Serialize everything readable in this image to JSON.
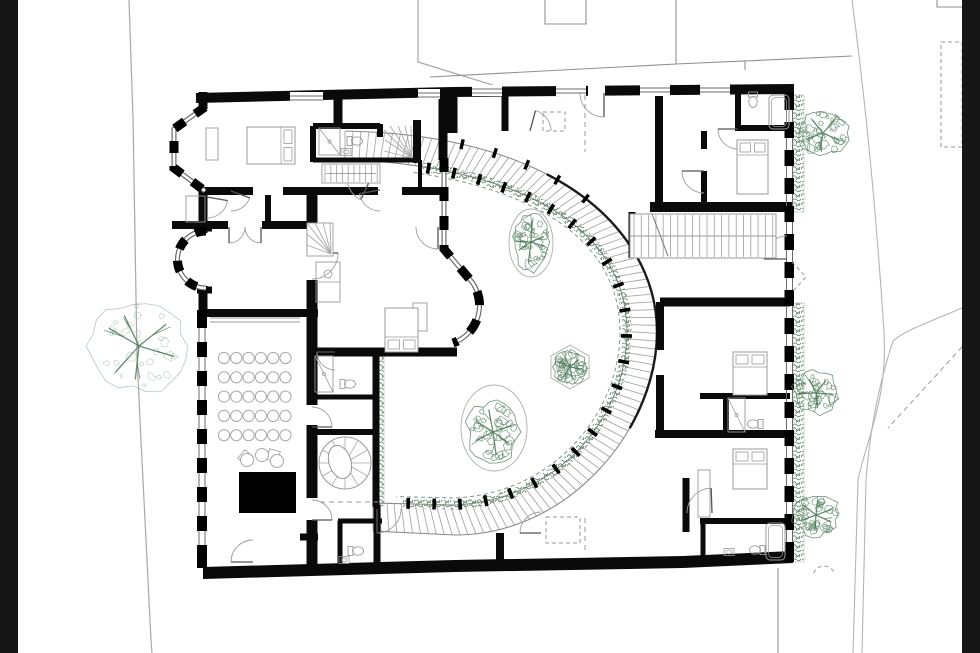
{
  "title": "floor-plan-drawing",
  "canvas": {
    "w": 980,
    "h": 653
  },
  "colors": {
    "paper": "#ffffff",
    "bar": "#161616",
    "wall": "#0a0a0a",
    "thin": "#9a9a9a",
    "boundary": "#a8a8a8",
    "road": "#b5b5b5",
    "neighbor": "#8f8f8f",
    "glaze": "#6b6b6b",
    "tread": "#a8a8a8",
    "dash": "#9a9a9a",
    "furn": "#9a9a9a",
    "seat": "#a8a8a8",
    "treeLight": "#9cb8a3",
    "treeDark": "#5d8768",
    "branch": "#4c7c59",
    "veg": "#55815f",
    "rail": "#7d9b88",
    "stage": "#000000"
  },
  "letterbox": {
    "left": [
      0,
      0,
      18,
      653
    ],
    "right": [
      962,
      0,
      18,
      653
    ]
  },
  "paperRect": [
    18,
    0,
    944,
    653
  ],
  "siteBoundaries": [
    "M129,0 L133,118 L137,356 L140,420 L151,640 L152,653",
    "M418,0 L418,62 L512,91"
  ],
  "neighborLines": [
    "M430,77 L676,64 L676,0",
    "M676,64 L745,61 L745,70",
    "M745,61 L852,56",
    "M545,0 L545,24 L586,24 L586,0",
    "M937,0 L937,7 L962,7",
    "M778,568 L778,653"
  ],
  "roads": [
    "M852,0 C868,120 878,240 884,332 C888,400 866,440 858,480 L853,653",
    "M962,308 C930,322 905,330 893,341 C877,390 869,440 866,480 L862,653"
  ],
  "dashedLines": [
    [
      585,
      95,
      585,
      152
    ],
    [
      585,
      518,
      585,
      552
    ],
    [
      320,
      502,
      378,
      502
    ],
    [
      962,
      347,
      888,
      428
    ]
  ],
  "dashedRects": [
    [
      543,
      112,
      22,
      19
    ],
    [
      546,
      517,
      34,
      26
    ],
    [
      941,
      42,
      21,
      105
    ]
  ],
  "dashedPolys": [
    "M792,262 L806,277 L792,292"
  ],
  "dashedArcs": [
    {
      "cx": 824,
      "cy": 577,
      "r": 11,
      "a0": 200,
      "a1": 340
    }
  ],
  "walls": [
    [
      196,
      98,
      452,
      92,
      10
    ],
    [
      452,
      92,
      794,
      89,
      10
    ],
    [
      452,
      88,
      452,
      133,
      11
    ],
    [
      443,
      92,
      443,
      160,
      9
    ],
    [
      505,
      93,
      505,
      131,
      7
    ],
    [
      659,
      92,
      659,
      211,
      8
    ],
    [
      704,
      131,
      704,
      149,
      6
    ],
    [
      704,
      171,
      704,
      211,
      6
    ],
    [
      738,
      92,
      738,
      129,
      6
    ],
    [
      735,
      128,
      792,
      128,
      6
    ],
    [
      650,
      207,
      792,
      207,
      10
    ],
    [
      660,
      302,
      790,
      302,
      9
    ],
    [
      660,
      302,
      660,
      350,
      8
    ],
    [
      660,
      375,
      660,
      434,
      8
    ],
    [
      655,
      434,
      790,
      434,
      8
    ],
    [
      700,
      396,
      790,
      396,
      6
    ],
    [
      726,
      396,
      726,
      434,
      6
    ],
    [
      700,
      521,
      790,
      521,
      6
    ],
    [
      703,
      521,
      703,
      560,
      5
    ],
    [
      686,
      478,
      686,
      532,
      7
    ],
    [
      312,
      195,
      312,
      253,
      11
    ],
    [
      312,
      280,
      312,
      405,
      11
    ],
    [
      312,
      425,
      312,
      498,
      11
    ],
    [
      312,
      520,
      312,
      575,
      11
    ],
    [
      203,
      191,
      253,
      191,
      8
    ],
    [
      283,
      191,
      378,
      191,
      8
    ],
    [
      402,
      191,
      447,
      191,
      8
    ],
    [
      172,
      225,
      228,
      225,
      8
    ],
    [
      262,
      225,
      312,
      225,
      8
    ],
    [
      268,
      195,
      268,
      225,
      6
    ],
    [
      203,
      92,
      203,
      109,
      9
    ],
    [
      203,
      189,
      203,
      233,
      9
    ],
    [
      203,
      286,
      203,
      315,
      9
    ],
    [
      197,
      228,
      212,
      228,
      7
    ],
    [
      197,
      290,
      212,
      290,
      7
    ],
    [
      205,
      313,
      318,
      313,
      8
    ],
    [
      308,
      352,
      457,
      352,
      9
    ],
    [
      376,
      352,
      376,
      507,
      7
    ],
    [
      312,
      397,
      376,
      397,
      5
    ],
    [
      312,
      432,
      376,
      432,
      6
    ],
    [
      340,
      521,
      340,
      572,
      5
    ],
    [
      338,
      521,
      382,
      521,
      5
    ],
    [
      377,
      505,
      377,
      572,
      7
    ],
    [
      313,
      126,
      380,
      126,
      6
    ],
    [
      380,
      124,
      380,
      137,
      6
    ],
    [
      417,
      120,
      417,
      163,
      8
    ],
    [
      313,
      160,
      420,
      160,
      5
    ],
    [
      313,
      126,
      313,
      162,
      6
    ],
    [
      420,
      160,
      420,
      191,
      4
    ],
    [
      338,
      92,
      338,
      127,
      9
    ],
    [
      300,
      537,
      318,
      537,
      7
    ],
    [
      500,
      533,
      500,
      564,
      8
    ],
    [
      632,
      212,
      632,
      258,
      7
    ]
  ],
  "wallPolys": [
    [
      [
        203,
        567
      ],
      [
        455,
        560
      ],
      [
        683,
        556
      ],
      [
        683,
        568
      ],
      [
        455,
        572
      ],
      [
        203,
        579
      ]
    ],
    [
      [
        683,
        556
      ],
      [
        793,
        551
      ],
      [
        793,
        563
      ],
      [
        683,
        568
      ]
    ]
  ],
  "facades": [
    {
      "d": "M205,107 L174,129 L174,168 L205,191",
      "dash": "12 13"
    },
    {
      "d": "M206,231 A28 28 0 1 0 206,288",
      "dash": "11 12"
    },
    {
      "d": "M444,158 L444,249 L472,282 A40 40 0 0 1 453,343",
      "dash": "14 15"
    }
  ],
  "pierWalls": [
    {
      "x1": 786.5,
      "x2": 792.5,
      "y0": 92,
      "y1": 562,
      "bx": 784.5,
      "bw": 9.5,
      "from": 94,
      "step": 28,
      "bh": 16,
      "caps": [
        [
          92,
          16
        ],
        [
          544,
          18
        ]
      ]
    },
    {
      "x1": 199,
      "x2": 205,
      "y0": 310,
      "y1": 568,
      "bx": 197,
      "bw": 10,
      "from": 313,
      "step": 29,
      "bh": 15,
      "caps": [
        [
          310,
          16
        ],
        [
          550,
          18
        ]
      ]
    }
  ],
  "windows": [
    {
      "r": [
        472,
        85,
        30,
        11
      ],
      "lines": [
        [
          472,
          89,
          502,
          89
        ],
        [
          472,
          93,
          502,
          93
        ]
      ]
    },
    {
      "r": [
        556,
        85,
        30,
        11
      ],
      "lines": [
        [
          556,
          89,
          586,
          89
        ],
        [
          556,
          93,
          586,
          93
        ]
      ]
    },
    {
      "r": [
        640,
        85,
        30,
        11
      ],
      "lines": [
        [
          640,
          88,
          670,
          88
        ],
        [
          640,
          92,
          670,
          92
        ]
      ]
    },
    {
      "r": [
        700,
        84,
        30,
        11
      ],
      "lines": [
        [
          700,
          88,
          730,
          88
        ],
        [
          700,
          92,
          730,
          92
        ]
      ]
    },
    {
      "r": [
        588,
        85,
        17,
        11
      ],
      "lines": []
    },
    {
      "r": [
        290,
        92,
        33,
        11
      ],
      "lines": [
        [
          290,
          96,
          323,
          96
        ],
        [
          290,
          100,
          323,
          100
        ]
      ]
    },
    {
      "r": [
        418,
        89,
        22,
        10
      ],
      "lines": [
        [
          418,
          93,
          440,
          93
        ],
        [
          418,
          97,
          440,
          97
        ]
      ]
    }
  ],
  "thinLines": [
    [
      210,
      318,
      300,
      318
    ],
    [
      210,
      322,
      300,
      322
    ]
  ],
  "thinRects": [
    [
      186,
      196,
      19,
      26
    ],
    [
      413,
      303,
      14,
      28
    ],
    [
      698,
      470,
      12,
      47
    ],
    [
      206,
      128,
      12,
      32
    ]
  ],
  "walkway": {
    "outerD": "M345,131 C570,135 657,240 657,332 C657,428 570,535 455,535 L373,531",
    "innerD": "M345,159 C560,170 627,250 627,332 C627,415 560,500 455,505 L373,503",
    "treads": 102,
    "greenStart": 78,
    "greenEndTrim": 30,
    "postStart": 84,
    "postStep": 26,
    "outerPosts": [
      118,
      152,
      186,
      220,
      254
    ],
    "railStart": 70,
    "railEndTrim": 22,
    "railOffset": 7,
    "center": [
      455,
      332
    ]
  },
  "greenStrips": [
    [
      793,
      95,
      11,
      117
    ],
    [
      793,
      303,
      11,
      259
    ],
    [
      374,
      356,
      10,
      150
    ]
  ],
  "doors": [
    {
      "cx": 604,
      "cy": 93,
      "r": 24,
      "a0": 180,
      "a1": 90
    },
    {
      "cx": 530,
      "cy": 131,
      "r": 21,
      "a0": 0,
      "a1": -75
    },
    {
      "cx": 438,
      "cy": 227,
      "r": 22,
      "a0": 180,
      "a1": 90
    },
    {
      "cx": 371,
      "cy": 178,
      "r": 24,
      "a0": 180,
      "a1": 115
    },
    {
      "cx": 229,
      "cy": 227,
      "r": 16,
      "a0": 0,
      "a1": 90
    },
    {
      "cx": 261,
      "cy": 227,
      "r": 16,
      "a0": 180,
      "a1": 90
    },
    {
      "cx": 207,
      "cy": 197,
      "r": 21,
      "a0": 90,
      "a1": 10
    },
    {
      "cx": 312,
      "cy": 253,
      "r": 26,
      "a0": 90,
      "a1": 0
    },
    {
      "cx": 312,
      "cy": 427,
      "r": 20,
      "a0": 270,
      "a1": 360
    },
    {
      "cx": 312,
      "cy": 520,
      "r": 20,
      "a0": 270,
      "a1": 360
    },
    {
      "cx": 704,
      "cy": 171,
      "r": 22,
      "a0": 90,
      "a1": 180
    },
    {
      "cx": 738,
      "cy": 129,
      "r": 20,
      "a0": 90,
      "a1": 180
    },
    {
      "cx": 787,
      "cy": 259,
      "r": 23,
      "a0": 270,
      "a1": 180
    },
    {
      "cx": 712,
      "cy": 513,
      "r": 25,
      "a0": 180,
      "a1": 268
    },
    {
      "cx": 377,
      "cy": 509,
      "r": 24,
      "a0": 0,
      "a1": 90
    },
    {
      "cx": 541,
      "cy": 533,
      "r": 21,
      "a0": 270,
      "a1": 180
    },
    {
      "cx": 253,
      "cy": 562,
      "r": 22,
      "a0": 270,
      "a1": 180
    },
    {
      "cx": 380,
      "cy": 190,
      "r": 21,
      "a0": 90,
      "a1": 170
    },
    {
      "cx": 231,
      "cy": 191,
      "r": 20,
      "a0": 90,
      "a1": 20
    },
    {
      "cx": 335,
      "cy": 352,
      "r": 18,
      "a0": 90,
      "a1": 180
    }
  ],
  "bridgeStair": {
    "x": 630,
    "y": 214,
    "w": 146,
    "h": 44,
    "step": 7.3,
    "breakLine": [
      652,
      214,
      668,
      256
    ]
  },
  "runStairs": [
    {
      "x": 322,
      "y": 164,
      "w": 58,
      "h": 19,
      "step": 5.8
    }
  ],
  "winders": [
    {
      "lines": [
        [
          412,
          158,
          384,
          130
        ],
        [
          412,
          158,
          390,
          126
        ],
        [
          412,
          158,
          398,
          126
        ],
        [
          412,
          158,
          405,
          126
        ],
        [
          412,
          158,
          411,
          126
        ],
        [
          412,
          158,
          385,
          140
        ],
        [
          412,
          158,
          384,
          151
        ]
      ]
    },
    {
      "rect": [
        307,
        223,
        26,
        33
      ],
      "lines": [
        [
          331,
          254,
          308,
          224
        ],
        [
          331,
          254,
          315,
          223
        ],
        [
          331,
          254,
          323,
          223
        ],
        [
          331,
          254,
          330,
          223
        ],
        [
          331,
          254,
          307,
          234
        ],
        [
          331,
          254,
          307,
          245
        ]
      ]
    }
  ],
  "spiralStair": {
    "cx": 345,
    "cy": 463,
    "r": 26,
    "spokes": 12,
    "inner": {
      "cx": 340,
      "cy": 462,
      "rx": 11,
      "ry": 17,
      "rot": -18
    }
  },
  "seatGrid": {
    "x0": 224,
    "y0": 358,
    "dx": 12.3,
    "dy": 19.3,
    "cols": 6,
    "rows": 5,
    "r": 5.6
  },
  "loungeChairs": [
    {
      "cx": 247,
      "cy": 460,
      "r": 6.5
    },
    {
      "cx": 262,
      "cy": 455,
      "r": 6.5
    },
    {
      "cx": 277,
      "cy": 461,
      "r": 6.5
    }
  ],
  "loungeSquares": [
    {
      "x": 240,
      "y": 452,
      "s": 11,
      "rot": 40
    },
    {
      "x": 268,
      "y": 450,
      "s": 11,
      "rot": 15
    }
  ],
  "stage": [
    239,
    472,
    57,
    41
  ],
  "beds": [
    {
      "x": 247,
      "y": 127,
      "w": 48,
      "h": 37,
      "p": "right"
    },
    {
      "x": 737,
      "y": 140,
      "w": 31,
      "h": 54,
      "p": "top"
    },
    {
      "x": 385,
      "y": 308,
      "w": 33,
      "h": 44,
      "p": "bottom"
    },
    {
      "x": 733,
      "y": 352,
      "w": 34,
      "h": 43,
      "p": "top"
    },
    {
      "x": 733,
      "y": 449,
      "w": 34,
      "h": 40,
      "p": "top"
    }
  ],
  "wcs": [
    {
      "x": 753,
      "y": 104,
      "rot": 90
    },
    {
      "x": 359,
      "y": 141,
      "rot": 0
    },
    {
      "x": 352,
      "y": 384,
      "rot": 0
    },
    {
      "x": 360,
      "y": 551,
      "rot": 0
    },
    {
      "x": 751,
      "y": 424,
      "rot": 180
    },
    {
      "x": 753,
      "y": 550,
      "rot": 180
    }
  ],
  "sinks": [
    [
      346,
      152
    ],
    [
      344,
      560
    ],
    [
      729,
      552
    ]
  ],
  "tubs": [
    {
      "x": 769,
      "y": 95,
      "w": 20,
      "h": 34
    },
    {
      "x": 766,
      "y": 523,
      "w": 19,
      "h": 37
    }
  ],
  "showers": [
    {
      "x": 319,
      "y": 128,
      "w": 21,
      "h": 27
    },
    {
      "x": 315,
      "y": 356,
      "w": 18,
      "h": 36
    },
    {
      "x": 728,
      "y": 398,
      "w": 17,
      "h": 34
    }
  ],
  "counter": {
    "x": 316,
    "y": 262,
    "w": 24,
    "h": 40,
    "sink": [
      328,
      274,
      4
    ]
  },
  "planters": [
    {
      "type": "ellipse",
      "cx": 531,
      "cy": 243,
      "rx": 22,
      "ry": 34
    },
    {
      "type": "hex",
      "cx": 570,
      "cy": 367,
      "r": 22
    },
    {
      "type": "ellipse",
      "cx": 494,
      "cy": 428,
      "rx": 33,
      "ry": 43
    }
  ],
  "trees": [
    {
      "cx": 139,
      "cy": 346,
      "rx": 51,
      "ry": 48,
      "light": true,
      "seed": 11
    },
    {
      "cx": 531,
      "cy": 242,
      "rx": 19,
      "ry": 30,
      "light": false,
      "seed": 22
    },
    {
      "cx": 570,
      "cy": 367,
      "rx": 17,
      "ry": 17,
      "light": false,
      "seed": 33
    },
    {
      "cx": 493,
      "cy": 432,
      "rx": 27,
      "ry": 33,
      "light": false,
      "seed": 44
    },
    {
      "cx": 823,
      "cy": 133,
      "rx": 26,
      "ry": 24,
      "light": false,
      "seed": 55
    },
    {
      "cx": 816,
      "cy": 393,
      "rx": 24,
      "ry": 22,
      "light": false,
      "seed": 66
    },
    {
      "cx": 816,
      "cy": 515,
      "rx": 24,
      "ry": 22,
      "light": false,
      "seed": 77
    }
  ]
}
